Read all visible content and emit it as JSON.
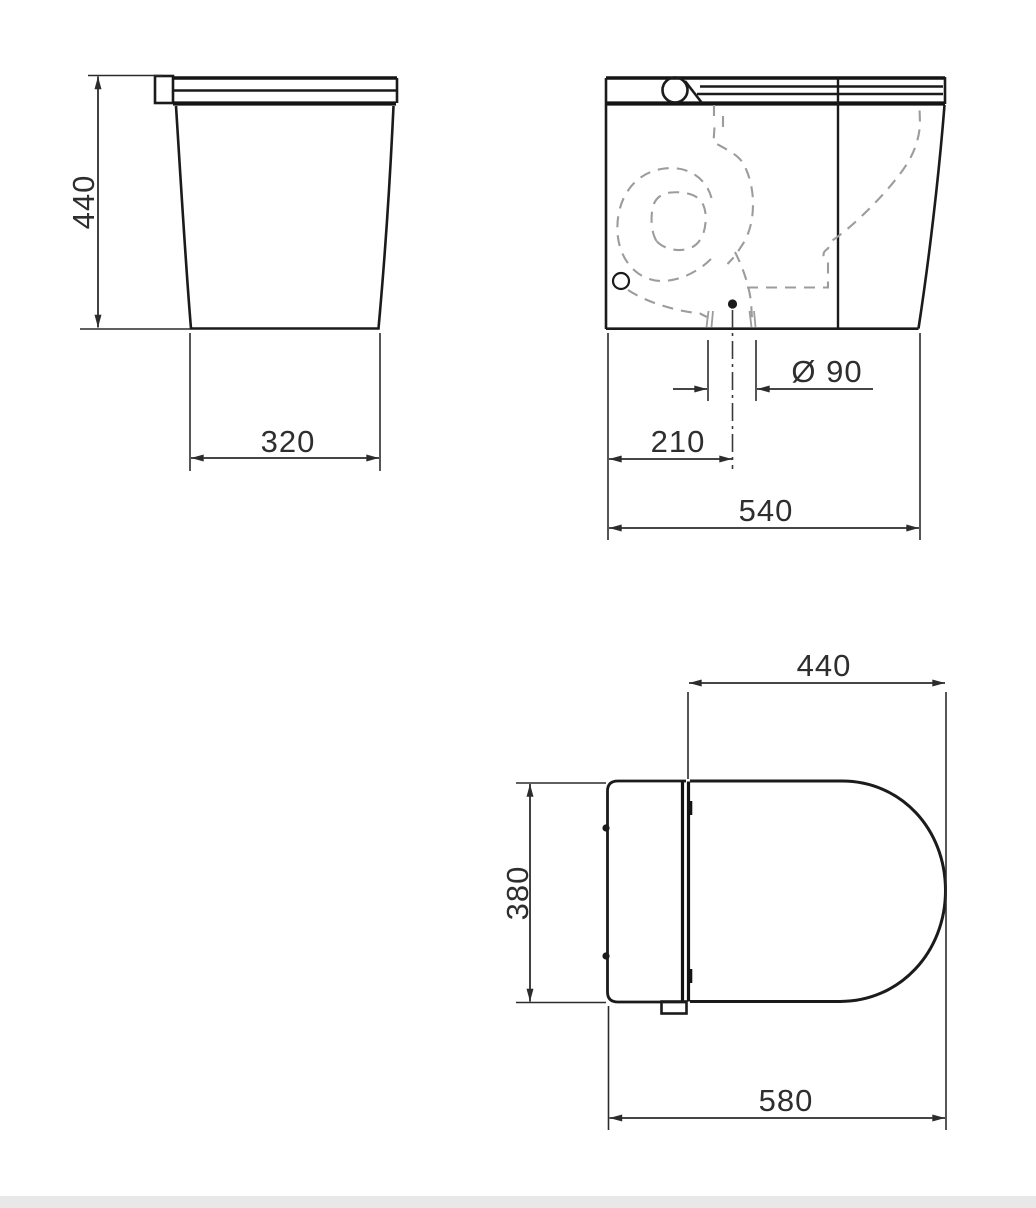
{
  "views": {
    "side": {
      "height_label": "440",
      "base_width_label": "320"
    },
    "front": {
      "diameter_label": "Ø 90",
      "offset_label": "210",
      "width_label": "540"
    },
    "top": {
      "depth_label": "440",
      "width_label": "380",
      "length_label": "580"
    }
  },
  "colors": {
    "line": "#1b1b1b",
    "dashed_hidden_line": "#9c9c9c",
    "dimension_text": "#2e2e2e",
    "background": "#ffffff",
    "footer_strip": "#e8e8e8"
  }
}
